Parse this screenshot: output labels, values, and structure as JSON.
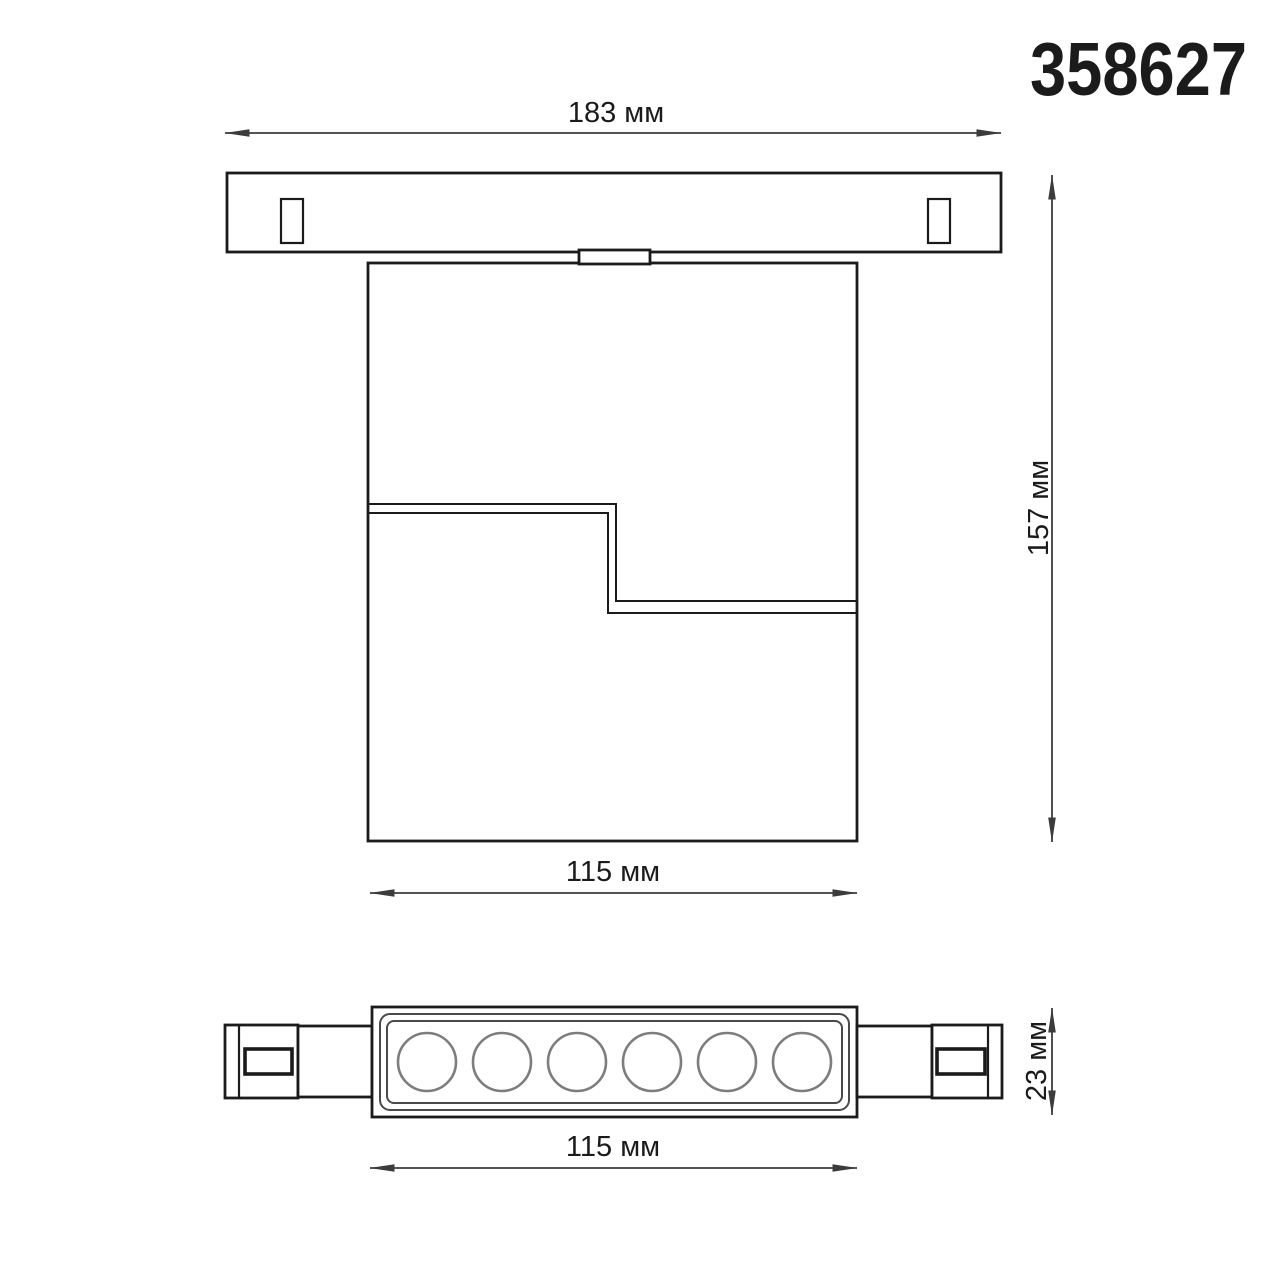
{
  "product_code": "358627",
  "units": "мм",
  "dimensions": {
    "track_length": {
      "value": 183,
      "unit": "мм",
      "label": "183 мм"
    },
    "overall_height": {
      "value": 157,
      "unit": "мм",
      "label": "157 мм"
    },
    "body_width": {
      "value": 115,
      "unit": "мм",
      "label": "115 мм"
    },
    "fixture_depth": {
      "value": 23,
      "unit": "мм",
      "label": "23 мм"
    },
    "body_width_bottom": {
      "value": 115,
      "unit": "мм",
      "label": "115 мм"
    }
  },
  "led_lenses": {
    "count": 6
  },
  "colors": {
    "background": "#ffffff",
    "outline": "#1b1b1b",
    "dimension": "#3c3c3c",
    "lens_stroke": "#7d7d7d"
  }
}
